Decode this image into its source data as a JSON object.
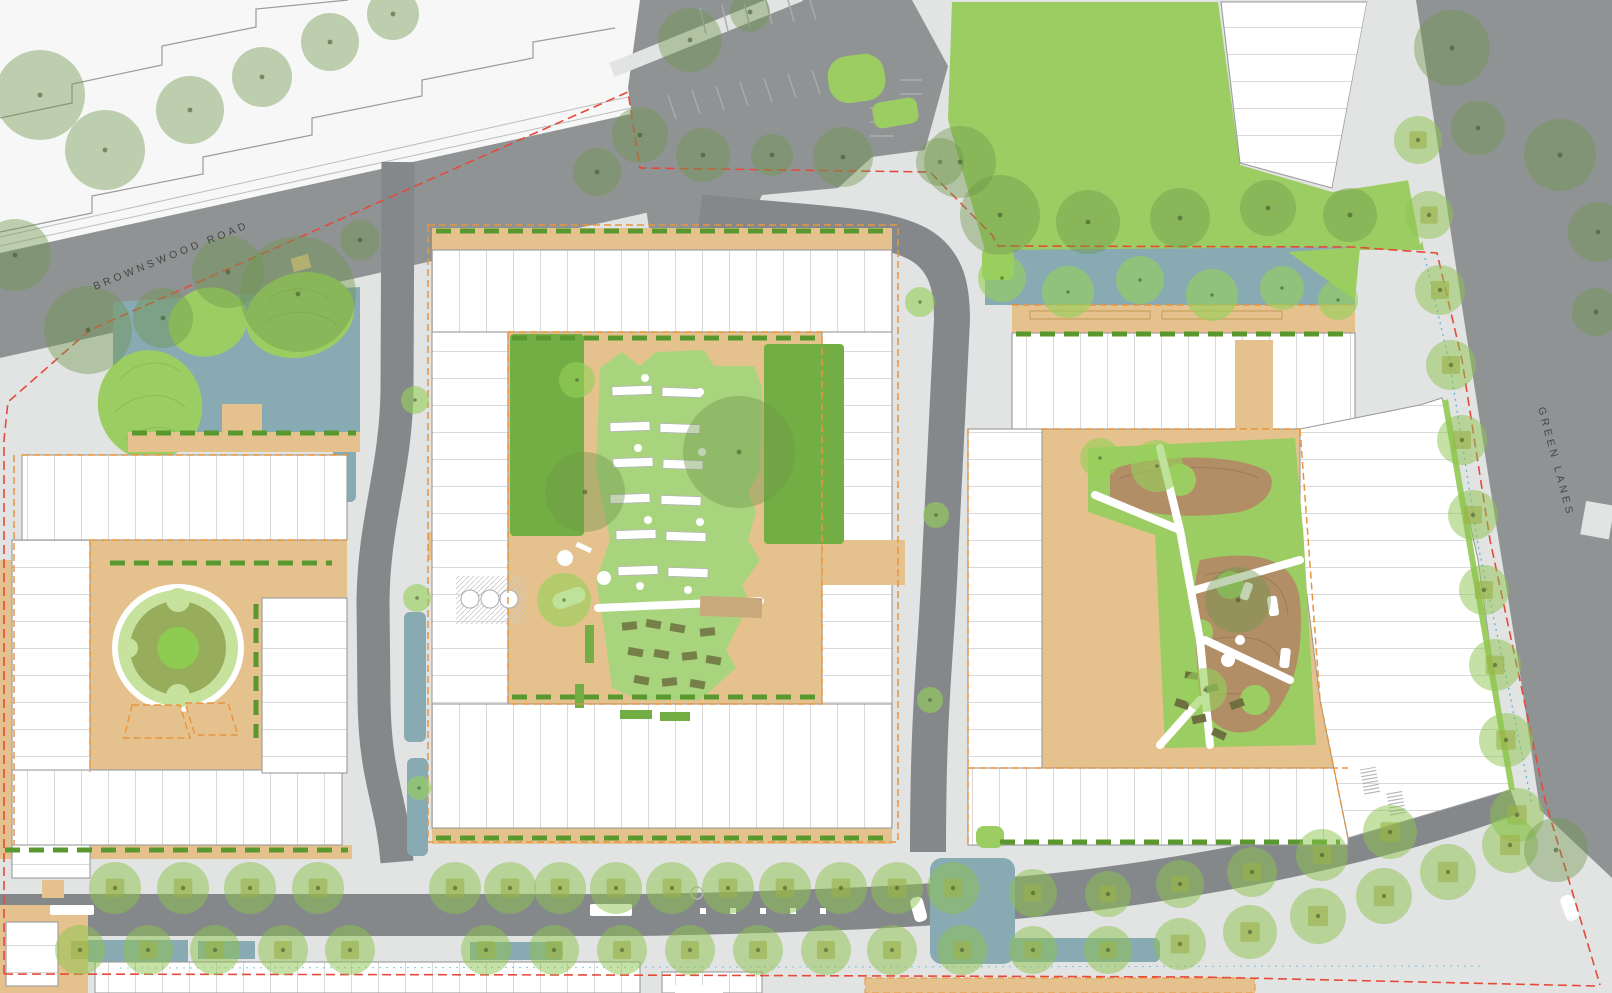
{
  "labels": {
    "road_top_left": "BROWNSWOOD ROAD",
    "road_right": "GREEN LANES"
  },
  "colors": {
    "paving": "#e2e3e3",
    "existing": "#f6f7f6",
    "outline": "#9a9b9c",
    "road": "#909394",
    "carriageway": "#85888a",
    "tan": "#e5c28d",
    "deck": "#c9a87b",
    "teal": "#88aab3",
    "lawn_bright": "#9ccd62",
    "lawn_dark": "#72ae43",
    "lawn_light": "#a9d47e",
    "ring_light": "#c6e29c",
    "ring_olive": "#97ad5b",
    "ring_center": "#8ecb52",
    "mound": "#b28e66",
    "mound_line": "#8a6b4a",
    "hedge": "#59982f",
    "contour": "#86b554",
    "tree_canopy": "rgba(110,150,75,0.42)",
    "tree_street": "rgba(139,196,77,0.50)",
    "tree_bright": "rgba(150,208,90,0.62)",
    "tree_dot": "rgba(60,80,40,0.55)",
    "planter": "rgba(170,160,70,0.62)",
    "furniture": "#6e7040",
    "red": "#e44a3c",
    "blue": "#5bb7d5",
    "orange": "#e8953f",
    "bay": "#aaacad",
    "label": "#454646"
  },
  "trees": {
    "canopy": [
      [
        40,
        95,
        45
      ],
      [
        105,
        150,
        40
      ],
      [
        190,
        110,
        34
      ],
      [
        262,
        77,
        30
      ],
      [
        330,
        42,
        29
      ],
      [
        393,
        14,
        26
      ],
      [
        15,
        255,
        36
      ],
      [
        88,
        330,
        44
      ],
      [
        163,
        318,
        30
      ],
      [
        228,
        272,
        36
      ],
      [
        298,
        294,
        58
      ],
      [
        360,
        240,
        20
      ],
      [
        690,
        40,
        32
      ],
      [
        750,
        12,
        20
      ],
      [
        703,
        155,
        27
      ],
      [
        772,
        155,
        21
      ],
      [
        843,
        157,
        30
      ],
      [
        940,
        162,
        24
      ],
      [
        640,
        135,
        28
      ],
      [
        597,
        172,
        24
      ],
      [
        960,
        162,
        36
      ],
      [
        1000,
        215,
        40
      ],
      [
        1088,
        222,
        32
      ],
      [
        1180,
        218,
        30
      ],
      [
        1268,
        208,
        28
      ],
      [
        1350,
        215,
        27
      ],
      [
        1452,
        48,
        38
      ],
      [
        1478,
        128,
        27
      ],
      [
        1560,
        155,
        36
      ],
      [
        1598,
        232,
        30
      ],
      [
        1596,
        312,
        24
      ],
      [
        739,
        452,
        56
      ],
      [
        585,
        492,
        40
      ],
      [
        1238,
        600,
        33
      ],
      [
        1556,
        850,
        32
      ]
    ],
    "street": [
      [
        1418,
        140,
        24
      ],
      [
        1429,
        215,
        24
      ],
      [
        1440,
        290,
        25
      ],
      [
        1451,
        365,
        25
      ],
      [
        1462,
        440,
        25
      ],
      [
        1473,
        515,
        25
      ],
      [
        1484,
        590,
        25
      ],
      [
        1495,
        665,
        26
      ],
      [
        1506,
        740,
        27
      ],
      [
        1517,
        815,
        27
      ],
      [
        115,
        888,
        26
      ],
      [
        183,
        888,
        26
      ],
      [
        250,
        888,
        26
      ],
      [
        318,
        888,
        26
      ],
      [
        455,
        888,
        26
      ],
      [
        510,
        888,
        26
      ],
      [
        560,
        888,
        26
      ],
      [
        616,
        888,
        26
      ],
      [
        672,
        888,
        26
      ],
      [
        728,
        888,
        26
      ],
      [
        785,
        888,
        26
      ],
      [
        841,
        888,
        26
      ],
      [
        897,
        888,
        26
      ],
      [
        953,
        888,
        26
      ],
      [
        1033,
        893,
        24
      ],
      [
        1108,
        894,
        23
      ],
      [
        1180,
        884,
        24
      ],
      [
        1252,
        872,
        25
      ],
      [
        1322,
        855,
        26
      ],
      [
        1390,
        832,
        27
      ],
      [
        80,
        950,
        25
      ],
      [
        148,
        950,
        25
      ],
      [
        215,
        950,
        25
      ],
      [
        283,
        950,
        25
      ],
      [
        350,
        950,
        25
      ],
      [
        486,
        950,
        25
      ],
      [
        554,
        950,
        25
      ],
      [
        622,
        950,
        25
      ],
      [
        690,
        950,
        25
      ],
      [
        758,
        950,
        25
      ],
      [
        826,
        950,
        25
      ],
      [
        892,
        950,
        25
      ],
      [
        962,
        950,
        25
      ],
      [
        1033,
        950,
        24
      ],
      [
        1108,
        950,
        24
      ],
      [
        1180,
        944,
        26
      ],
      [
        1250,
        932,
        27
      ],
      [
        1318,
        916,
        28
      ],
      [
        1384,
        896,
        28
      ],
      [
        1448,
        872,
        28
      ],
      [
        1510,
        845,
        28
      ]
    ],
    "bright": [
      [
        415,
        400,
        14
      ],
      [
        417,
        598,
        14
      ],
      [
        419,
        788,
        12
      ],
      [
        920,
        302,
        15
      ],
      [
        936,
        515,
        13
      ],
      [
        930,
        700,
        13
      ],
      [
        564,
        600,
        27
      ],
      [
        1157,
        466,
        26
      ],
      [
        1205,
        690,
        22
      ],
      [
        1100,
        458,
        20
      ],
      [
        1002,
        278,
        24
      ],
      [
        1068,
        292,
        26
      ],
      [
        1140,
        280,
        24
      ],
      [
        1212,
        295,
        26
      ],
      [
        1282,
        288,
        22
      ],
      [
        1338,
        300,
        20
      ],
      [
        577,
        380,
        18
      ]
    ]
  },
  "allotment": {
    "beds": [
      [
        612,
        386
      ],
      [
        662,
        388
      ],
      [
        610,
        422
      ],
      [
        660,
        424
      ],
      [
        613,
        458
      ],
      [
        663,
        460
      ],
      [
        610,
        494
      ],
      [
        661,
        496
      ],
      [
        616,
        530
      ],
      [
        666,
        532
      ],
      [
        618,
        566
      ],
      [
        668,
        568
      ]
    ],
    "dots": [
      [
        645,
        378
      ],
      [
        700,
        392
      ],
      [
        638,
        448
      ],
      [
        702,
        452
      ],
      [
        648,
        520
      ],
      [
        700,
        522
      ],
      [
        640,
        586
      ],
      [
        688,
        590
      ]
    ],
    "tables": [
      [
        622,
        622
      ],
      [
        646,
        620
      ],
      [
        670,
        624
      ],
      [
        700,
        628
      ],
      [
        628,
        648
      ],
      [
        654,
        650
      ],
      [
        682,
        652
      ],
      [
        706,
        656
      ],
      [
        634,
        676
      ],
      [
        662,
        678
      ],
      [
        690,
        680
      ]
    ]
  },
  "hedges": [
    [
      110,
      563,
      332,
      563
    ],
    [
      256,
      604,
      256,
      738
    ],
    [
      132,
      433,
      356,
      433
    ],
    [
      436,
      231,
      888,
      231
    ],
    [
      512,
      338,
      818,
      338
    ],
    [
      512,
      697,
      818,
      697
    ],
    [
      436,
      838,
      888,
      838
    ],
    [
      1016,
      334,
      1352,
      334
    ],
    [
      1000,
      842,
      1340,
      842
    ],
    [
      5,
      850,
      348,
      850
    ]
  ],
  "boundary": {
    "red_a": [
      [
        4,
        974
      ],
      [
        4,
        440
      ],
      [
        8,
        402
      ],
      [
        90,
        330
      ],
      [
        628,
        92
      ],
      [
        640,
        168
      ],
      [
        930,
        172
      ],
      [
        992,
        235
      ],
      [
        998,
        246
      ],
      [
        1352,
        247
      ],
      [
        1437,
        253
      ],
      [
        1462,
        360
      ],
      [
        1490,
        540
      ],
      [
        1522,
        690
      ],
      [
        1545,
        800
      ],
      [
        1600,
        985
      ]
    ],
    "red_b": [
      [
        4,
        974
      ],
      [
        600,
        975
      ],
      [
        1200,
        977
      ],
      [
        1597,
        986
      ]
    ],
    "blue_a": [
      [
        1425,
        258
      ],
      [
        1450,
        365
      ],
      [
        1478,
        545
      ],
      [
        1510,
        695
      ],
      [
        1532,
        805
      ]
    ],
    "blue_b": [
      [
        120,
        968
      ],
      [
        1480,
        966
      ]
    ]
  }
}
